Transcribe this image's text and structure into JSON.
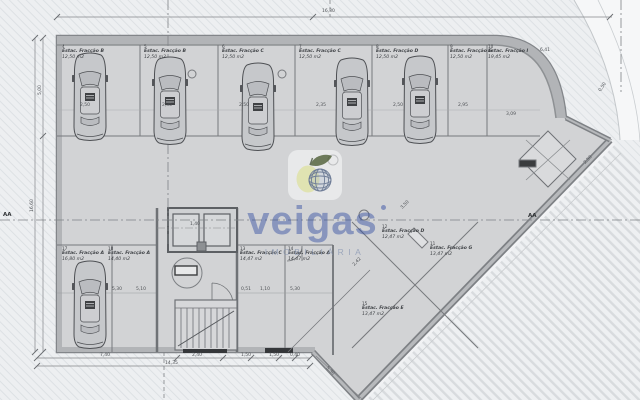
{
  "colors": {
    "brand_blue": "#2b47a0",
    "interior_gray": "#d2d3d5",
    "wall_gray": "#7e8185",
    "tagline_gray": "#8a97b0"
  },
  "watermark": {
    "brand": "veigas",
    "tagline": "IMOBILIÁRIA"
  },
  "parking_spaces": [
    {
      "num": "4",
      "name": "Estac. Fracção B",
      "area": "12,50 m2",
      "x": 62,
      "y": 44
    },
    {
      "num": "5",
      "name": "Estac. Fracção B",
      "area": "12,50 m2",
      "x": 144,
      "y": 44
    },
    {
      "num": "6",
      "name": "Estac. Fracção C",
      "area": "12,50 m2",
      "x": 222,
      "y": 44
    },
    {
      "num": "7",
      "name": "Estac. Fracção C",
      "area": "12,50 m2",
      "x": 299,
      "y": 44
    },
    {
      "num": "8",
      "name": "Estac. Fracção D",
      "area": "12,50 m2",
      "x": 376,
      "y": 44
    },
    {
      "num": "9",
      "name": "Estac. Fracção G",
      "area": "12,50 m2",
      "x": 450,
      "y": 44
    },
    {
      "num": "10",
      "name": "Estac. Fracção I",
      "area": "19,45 m2",
      "x": 488,
      "y": 44
    },
    {
      "num": "12",
      "name": "Estac. Fracção D",
      "area": "12,47 m2",
      "x": 382,
      "y": 224
    },
    {
      "num": "11",
      "name": "Estac. Fracção G",
      "area": "13,47 m2",
      "x": 430,
      "y": 241
    },
    {
      "num": "13",
      "name": "Estac. Fracção C",
      "area": "14,47 m2",
      "x": 240,
      "y": 246
    },
    {
      "num": "14",
      "name": "Estac. Fracção A",
      "area": "14,47 m2",
      "x": 288,
      "y": 246
    },
    {
      "num": "15",
      "name": "Estac. Fracção E",
      "area": "13,47 m2",
      "x": 362,
      "y": 301
    },
    {
      "num": "17",
      "name": "Estac. Fracção A",
      "area": "16,80 m2",
      "x": 62,
      "y": 246
    },
    {
      "num": "18",
      "name": "Estac. Fracção A",
      "area": "14,40 m2",
      "x": 108,
      "y": 246
    }
  ],
  "dimensions": [
    {
      "text": "16,30",
      "x": 322,
      "y": 9
    },
    {
      "text": "5,00",
      "x": 38,
      "y": 95,
      "rot": -90
    },
    {
      "text": "16,60",
      "x": 30,
      "y": 212,
      "rot": -90
    },
    {
      "text": "2,50",
      "x": 80,
      "y": 103
    },
    {
      "text": "2,35",
      "x": 162,
      "y": 103
    },
    {
      "text": "2,50",
      "x": 239,
      "y": 103
    },
    {
      "text": "2,35",
      "x": 316,
      "y": 103
    },
    {
      "text": "2,50",
      "x": 393,
      "y": 103
    },
    {
      "text": "2,95",
      "x": 458,
      "y": 103
    },
    {
      "text": "3,09",
      "x": 506,
      "y": 112
    },
    {
      "text": "6,41",
      "x": 540,
      "y": 48
    },
    {
      "text": "0,50",
      "x": 598,
      "y": 90,
      "rot": -55
    },
    {
      "text": "2,50",
      "x": 583,
      "y": 162,
      "rot": -45
    },
    {
      "text": "3,50",
      "x": 400,
      "y": 207,
      "rot": -45
    },
    {
      "text": "2,42",
      "x": 352,
      "y": 264,
      "rot": -45
    },
    {
      "text": "1,40",
      "x": 190,
      "y": 222
    },
    {
      "text": "0,51",
      "x": 241,
      "y": 287
    },
    {
      "text": "1,10",
      "x": 260,
      "y": 287
    },
    {
      "text": "5,30",
      "x": 290,
      "y": 287
    },
    {
      "text": "5,30",
      "x": 112,
      "y": 287
    },
    {
      "text": "5,10",
      "x": 136,
      "y": 287
    },
    {
      "text": "7,40",
      "x": 100,
      "y": 353
    },
    {
      "text": "2,40",
      "x": 192,
      "y": 353
    },
    {
      "text": "1,50",
      "x": 241,
      "y": 353
    },
    {
      "text": "1,50",
      "x": 269,
      "y": 353
    },
    {
      "text": "0,40",
      "x": 290,
      "y": 353
    },
    {
      "text": "14,35",
      "x": 165,
      "y": 361
    },
    {
      "text": "5,30",
      "x": 328,
      "y": 366,
      "rot": 45
    },
    {
      "text": "AA",
      "x": 3,
      "y": 212,
      "cls": "marker"
    },
    {
      "text": "AA",
      "x": 528,
      "y": 213,
      "cls": "marker"
    }
  ],
  "cars": [
    {
      "x": 72,
      "y": 50
    },
    {
      "x": 152,
      "y": 54
    },
    {
      "x": 240,
      "y": 60
    },
    {
      "x": 334,
      "y": 55
    },
    {
      "x": 402,
      "y": 53
    },
    {
      "x": 72,
      "y": 258
    }
  ]
}
